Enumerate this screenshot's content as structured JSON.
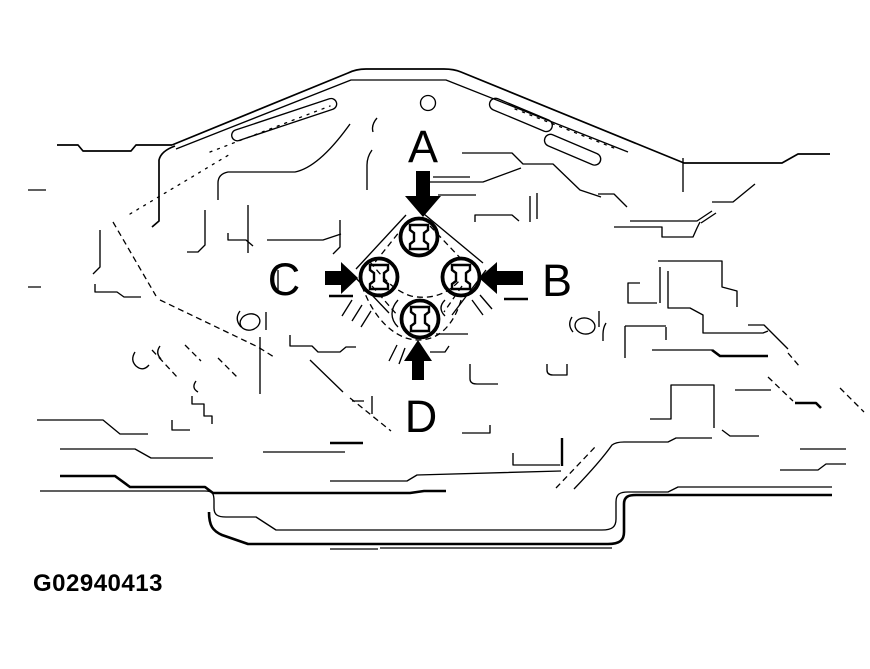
{
  "figure": {
    "caption_id": "G02940413",
    "labels": {
      "top": "A",
      "right": "B",
      "left": "C",
      "bottom": "D"
    },
    "colors": {
      "ink": "#000000",
      "paper": "#ffffff"
    },
    "icons": {
      "top_arrow": "arrow-down-icon",
      "right_arrow": "arrow-left-icon",
      "left_arrow": "arrow-right-icon",
      "bottom_arrow": "arrow-up-icon"
    }
  }
}
